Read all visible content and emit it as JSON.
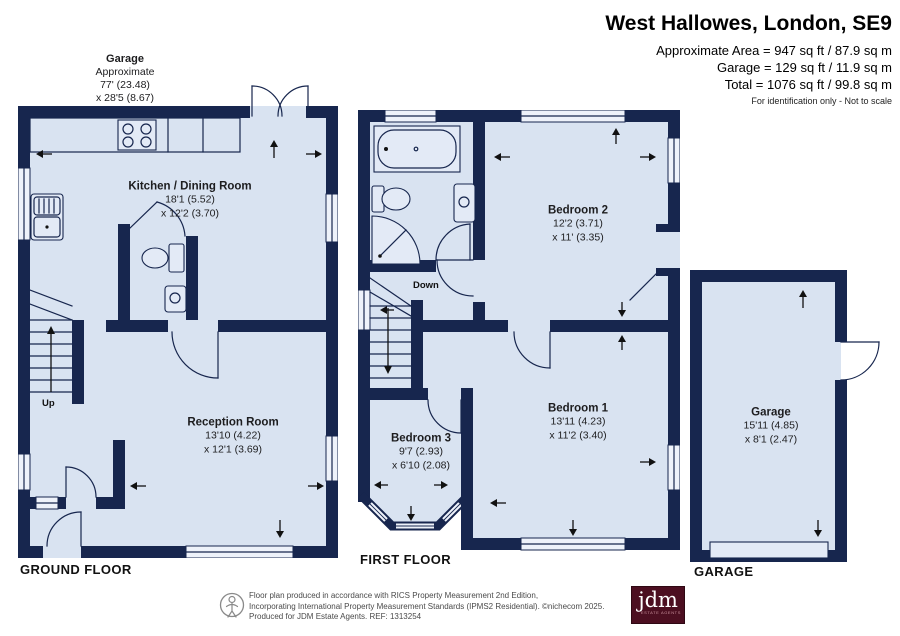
{
  "header": {
    "title": "West Hallowes, London, SE9",
    "area_line": "Approximate Area = 947 sq ft / 87.9 sq m",
    "garage_line": "Garage = 129 sq ft / 11.9 sq m",
    "total_line": "Total = 1076 sq ft / 99.8 sq m",
    "disclaimer": "For identification only - Not to scale"
  },
  "garage_annotation": {
    "name": "Garage",
    "line1": "Approximate",
    "line2": "77' (23.48)",
    "line3": "x 28'5 (8.67)"
  },
  "floors": {
    "ground": {
      "label": "GROUND FLOOR",
      "stairs_label": "Up"
    },
    "first": {
      "label": "FIRST FLOOR",
      "stairs_label": "Down"
    },
    "garage": {
      "label": "GARAGE"
    }
  },
  "rooms": {
    "kitchen": {
      "name": "Kitchen / Dining Room",
      "dim1": "18'1 (5.52)",
      "dim2": "x 12'2 (3.70)"
    },
    "reception": {
      "name": "Reception Room",
      "dim1": "13'10 (4.22)",
      "dim2": "x 12'1 (3.69)"
    },
    "bedroom2": {
      "name": "Bedroom 2",
      "dim1": "12'2 (3.71)",
      "dim2": "x 11' (3.35)"
    },
    "bedroom1": {
      "name": "Bedroom 1",
      "dim1": "13'11 (4.23)",
      "dim2": "x 11'2 (3.40)"
    },
    "bedroom3": {
      "name": "Bedroom 3",
      "dim1": "9'7 (2.93)",
      "dim2": "x 6'10 (2.08)"
    },
    "garage": {
      "name": "Garage",
      "dim1": "15'11 (4.85)",
      "dim2": "x 8'1 (2.47)"
    }
  },
  "footer": {
    "line1": "Floor plan produced in accordance with RICS Property Measurement 2nd Edition,",
    "line2": "Incorporating International Property Measurement Standards (IPMS2 Residential).  ©nichecom 2025.",
    "line3": "Produced for JDM Estate Agents.  REF: 1313254",
    "logo_text": "jdm",
    "logo_subtext": "ESTATE AGENTS"
  },
  "colors": {
    "wall": "#17264e",
    "floor": "#d9e3f1",
    "window": "#eef2fa",
    "logo_bg": "#4c0f21"
  }
}
